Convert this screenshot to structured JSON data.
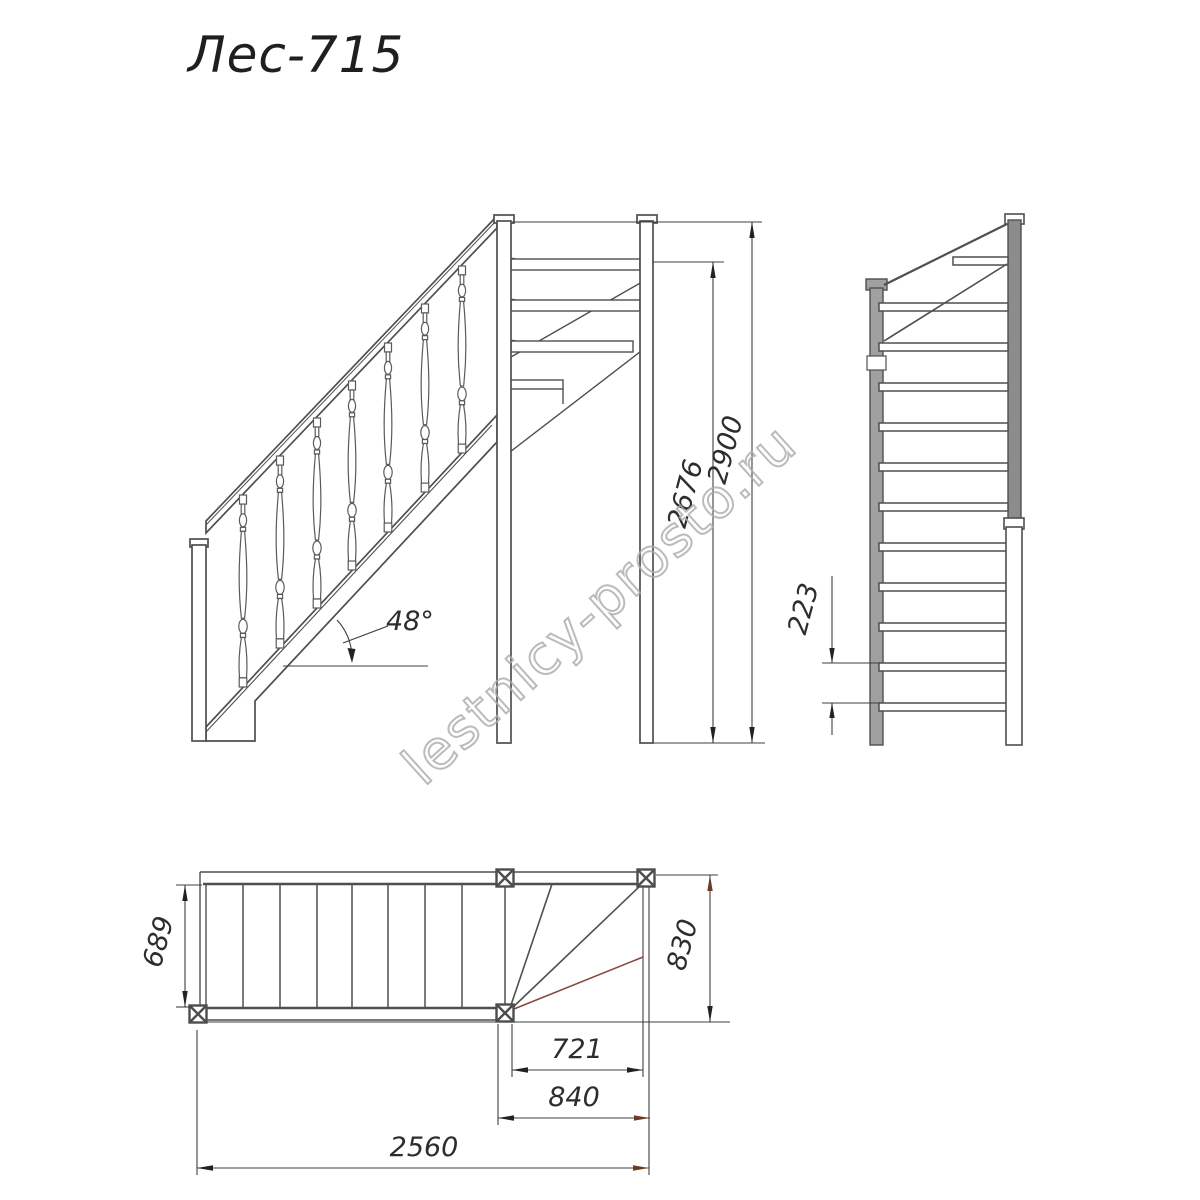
{
  "title": "Лес-715",
  "watermark": "lestnicy-prosto.ru",
  "dimensions": {
    "height_clear": "2676",
    "height_total": "2900",
    "step_rise": "223",
    "flight_width": "689",
    "winder_width": "830",
    "winder_run": "721",
    "winder_total": "840",
    "length_total": "2560",
    "stair_angle": "48°"
  },
  "colors": {
    "line": "#4f4f4f",
    "dimension": "#3a3a3a",
    "arrow": "#222222",
    "accent_arrow": "#6e3a28",
    "watermark": "#ababab",
    "post_fill": "#a0a0a0"
  }
}
